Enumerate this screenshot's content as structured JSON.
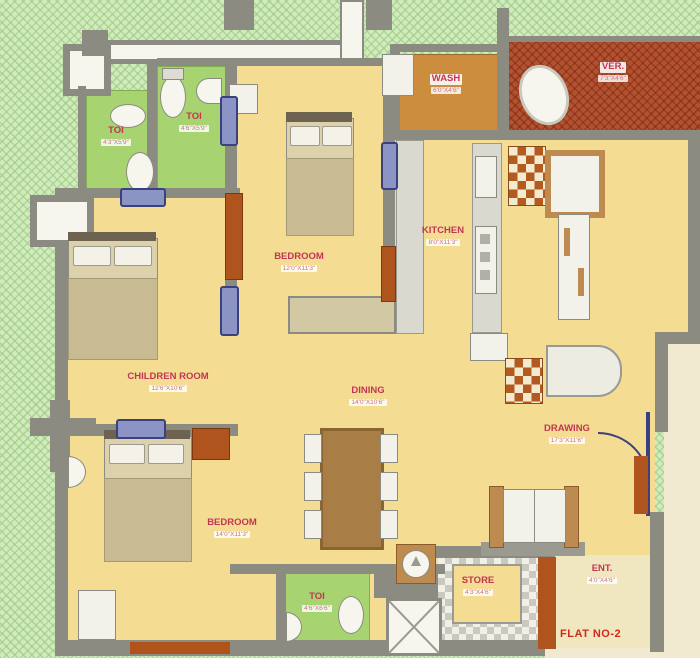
{
  "plan": {
    "flat_label": "FLAT NO-2",
    "rooms": [
      {
        "label": "TOI",
        "dims": "4'3\"X5'9\""
      },
      {
        "label": "TOI",
        "dims": "4'6\"X5'9\""
      },
      {
        "label": "BEDROOM",
        "dims": "12'0\"X11'3\""
      },
      {
        "label": "WASH",
        "dims": "6'0\"X4'6\""
      },
      {
        "label": "VER.",
        "dims": "7'3\"X4'6\""
      },
      {
        "label": "KITCHEN",
        "dims": "8'0\"X11'3\""
      },
      {
        "label": "CHILDREN ROOM",
        "dims": "12'6\"X10'6\""
      },
      {
        "label": "DINING",
        "dims": "14'0\"X10'6\""
      },
      {
        "label": "DRAWING",
        "dims": "17'3\"X11'6\""
      },
      {
        "label": "BEDROOM",
        "dims": "14'0\"X11'3\""
      },
      {
        "label": "TOI",
        "dims": "4'6\"X6'6\""
      },
      {
        "label": "STORE",
        "dims": "4'3\"X4'6\""
      },
      {
        "label": "ENT.",
        "dims": "4'0\"X4'6\""
      }
    ],
    "colors": {
      "floor": "#f4dc92",
      "toilet_floor": "#a7d470",
      "wall": "#8b8b81",
      "exterior": "#d2ebbc",
      "verandah": "#b4512e",
      "wash": "#cd8d3f",
      "door": "#8c94c6",
      "room_label": "#c23555",
      "flat_label": "#d3281c"
    }
  }
}
